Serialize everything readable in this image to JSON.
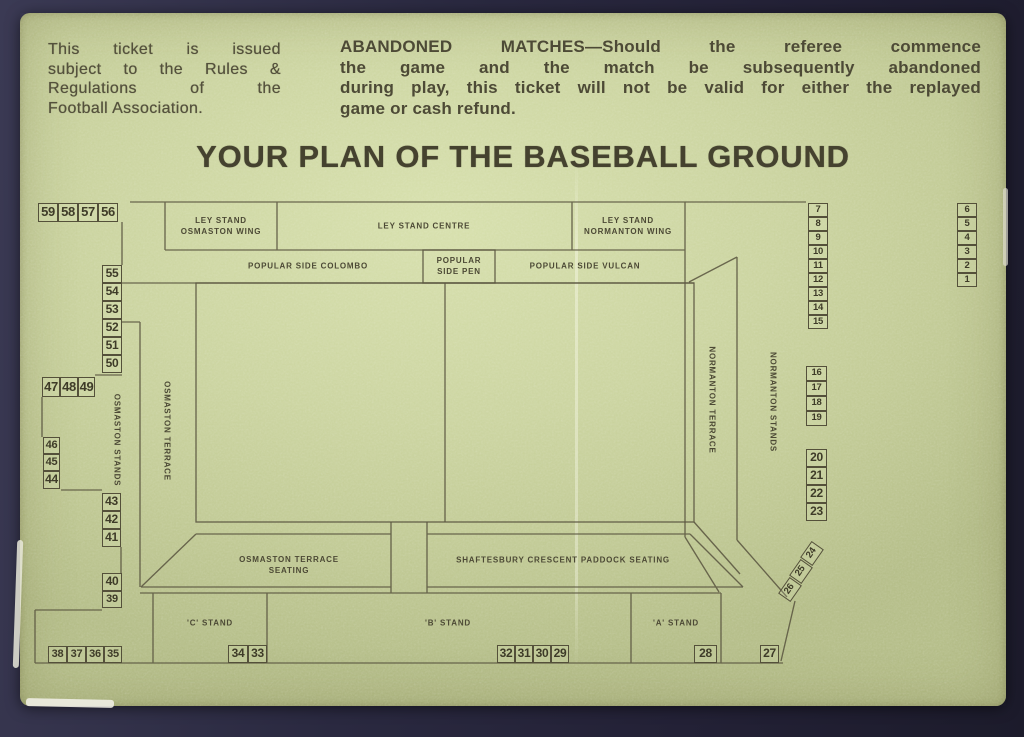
{
  "ticket": {
    "issue_notice": {
      "lines": [
        "This ticket is issued",
        "subject to the Rules &",
        "Regulations of the",
        "Football Association."
      ]
    },
    "abandoned_notice": {
      "lines": [
        "ABANDONED MATCHES—Should the referee commence",
        "the game and the match be subsequently abandoned",
        "during play, this ticket will not be valid for either the replayed",
        "game or cash refund."
      ]
    },
    "title": "YOUR PLAN OF THE BASEBALL GROUND"
  },
  "plan": {
    "labels": [
      {
        "id": "ley-stand-osmaston-wing",
        "text": "LEY STAND\nOSMASTON WING",
        "x": 221,
        "y": 227
      },
      {
        "id": "ley-stand-centre",
        "text": "LEY STAND CENTRE",
        "x": 424,
        "y": 227
      },
      {
        "id": "ley-stand-normanton-wing",
        "text": "LEY STAND\nNORMANTON WING",
        "x": 628,
        "y": 227
      },
      {
        "id": "popular-side-colombo",
        "text": "POPULAR SIDE  COLOMBO",
        "x": 308,
        "y": 267
      },
      {
        "id": "popular-side-pen",
        "text": "POPULAR\nSIDE PEN",
        "x": 459,
        "y": 267
      },
      {
        "id": "popular-side-vulcan",
        "text": "POPULAR SIDE  VULCAN",
        "x": 585,
        "y": 267
      },
      {
        "id": "osmaston-terrace-seating",
        "text": "OSMASTON TERRACE\nSEATING",
        "x": 289,
        "y": 566
      },
      {
        "id": "shaftesbury-crescent-paddock-seating",
        "text": "SHAFTESBURY CRESCENT PADDOCK SEATING",
        "x": 563,
        "y": 561
      },
      {
        "id": "c-stand",
        "text": "'C' STAND",
        "x": 210,
        "y": 624
      },
      {
        "id": "b-stand",
        "text": "'B' STAND",
        "x": 448,
        "y": 624
      },
      {
        "id": "a-stand",
        "text": "'A' STAND",
        "x": 676,
        "y": 624
      },
      {
        "id": "osmaston-stands",
        "text": "OSMASTON STANDS",
        "x": 116,
        "y": 440,
        "rot": 90
      },
      {
        "id": "osmaston-terrace",
        "text": "OSMASTON TERRACE",
        "x": 166,
        "y": 431,
        "rot": 90
      },
      {
        "id": "normanton-terrace",
        "text": "NORMANTON TERRACE",
        "x": 711,
        "y": 400,
        "rot": 90
      },
      {
        "id": "normanton-stands",
        "text": "NORMANTON STANDS",
        "x": 772,
        "y": 402,
        "rot": 90
      }
    ],
    "blocks": [
      {
        "n": 59,
        "x": 38,
        "y": 203,
        "w": 20,
        "h": 19
      },
      {
        "n": 58,
        "x": 58,
        "y": 203,
        "w": 20,
        "h": 19
      },
      {
        "n": 57,
        "x": 78,
        "y": 203,
        "w": 20,
        "h": 19
      },
      {
        "n": 56,
        "x": 98,
        "y": 203,
        "w": 20,
        "h": 19
      },
      {
        "n": 55,
        "x": 102,
        "y": 265,
        "w": 20,
        "h": 18
      },
      {
        "n": 54,
        "x": 102,
        "y": 283,
        "w": 20,
        "h": 18
      },
      {
        "n": 53,
        "x": 102,
        "y": 301,
        "w": 20,
        "h": 18
      },
      {
        "n": 52,
        "x": 102,
        "y": 319,
        "w": 20,
        "h": 18
      },
      {
        "n": 51,
        "x": 102,
        "y": 337,
        "w": 20,
        "h": 18
      },
      {
        "n": 50,
        "x": 102,
        "y": 355,
        "w": 20,
        "h": 18
      },
      {
        "n": 47,
        "x": 42,
        "y": 377,
        "w": 18,
        "h": 20
      },
      {
        "n": 48,
        "x": 60,
        "y": 377,
        "w": 18,
        "h": 20
      },
      {
        "n": 49,
        "x": 78,
        "y": 377,
        "w": 17,
        "h": 20
      },
      {
        "n": 46,
        "x": 43,
        "y": 437,
        "w": 17,
        "h": 17
      },
      {
        "n": 45,
        "x": 43,
        "y": 454,
        "w": 17,
        "h": 17
      },
      {
        "n": 44,
        "x": 43,
        "y": 471,
        "w": 17,
        "h": 18
      },
      {
        "n": 43,
        "x": 102,
        "y": 493,
        "w": 19,
        "h": 18
      },
      {
        "n": 42,
        "x": 102,
        "y": 511,
        "w": 19,
        "h": 18
      },
      {
        "n": 41,
        "x": 102,
        "y": 529,
        "w": 19,
        "h": 18
      },
      {
        "n": 40,
        "x": 102,
        "y": 573,
        "w": 20,
        "h": 18
      },
      {
        "n": 39,
        "x": 102,
        "y": 591,
        "w": 20,
        "h": 17
      },
      {
        "n": 38,
        "x": 48,
        "y": 646,
        "w": 19,
        "h": 17
      },
      {
        "n": 37,
        "x": 67,
        "y": 646,
        "w": 19,
        "h": 17
      },
      {
        "n": 36,
        "x": 86,
        "y": 646,
        "w": 18,
        "h": 17
      },
      {
        "n": 35,
        "x": 104,
        "y": 646,
        "w": 18,
        "h": 17
      },
      {
        "n": 34,
        "x": 228,
        "y": 645,
        "w": 20,
        "h": 18
      },
      {
        "n": 33,
        "x": 248,
        "y": 645,
        "w": 19,
        "h": 18
      },
      {
        "n": 32,
        "x": 497,
        "y": 645,
        "w": 18,
        "h": 18
      },
      {
        "n": 31,
        "x": 515,
        "y": 645,
        "w": 18,
        "h": 18
      },
      {
        "n": 30,
        "x": 533,
        "y": 645,
        "w": 18,
        "h": 18
      },
      {
        "n": 29,
        "x": 551,
        "y": 645,
        "w": 18,
        "h": 18
      },
      {
        "n": 28,
        "x": 694,
        "y": 645,
        "w": 23,
        "h": 18
      },
      {
        "n": 27,
        "x": 760,
        "y": 645,
        "w": 19,
        "h": 18
      },
      {
        "n": 26,
        "x": 780,
        "y": 582,
        "w": 20,
        "h": 15,
        "r": -55
      },
      {
        "n": 25,
        "x": 791,
        "y": 564,
        "w": 20,
        "h": 15,
        "r": -55
      },
      {
        "n": 24,
        "x": 802,
        "y": 546,
        "w": 20,
        "h": 15,
        "r": -55
      },
      {
        "n": 23,
        "x": 806,
        "y": 503,
        "w": 21,
        "h": 18
      },
      {
        "n": 22,
        "x": 806,
        "y": 485,
        "w": 21,
        "h": 18
      },
      {
        "n": 21,
        "x": 806,
        "y": 467,
        "w": 21,
        "h": 18
      },
      {
        "n": 20,
        "x": 806,
        "y": 449,
        "w": 21,
        "h": 18
      },
      {
        "n": 19,
        "x": 806,
        "y": 411,
        "w": 21,
        "h": 15
      },
      {
        "n": 18,
        "x": 806,
        "y": 396,
        "w": 21,
        "h": 15
      },
      {
        "n": 17,
        "x": 806,
        "y": 381,
        "w": 21,
        "h": 15
      },
      {
        "n": 16,
        "x": 806,
        "y": 366,
        "w": 21,
        "h": 15
      },
      {
        "n": 15,
        "x": 808,
        "y": 315,
        "w": 20,
        "h": 14
      },
      {
        "n": 14,
        "x": 808,
        "y": 301,
        "w": 20,
        "h": 14
      },
      {
        "n": 13,
        "x": 808,
        "y": 287,
        "w": 20,
        "h": 14
      },
      {
        "n": 12,
        "x": 808,
        "y": 273,
        "w": 20,
        "h": 14
      },
      {
        "n": 11,
        "x": 808,
        "y": 259,
        "w": 20,
        "h": 14
      },
      {
        "n": 10,
        "x": 808,
        "y": 245,
        "w": 20,
        "h": 14
      },
      {
        "n": 9,
        "x": 808,
        "y": 231,
        "w": 20,
        "h": 14
      },
      {
        "n": 8,
        "x": 808,
        "y": 217,
        "w": 20,
        "h": 14
      },
      {
        "n": 7,
        "x": 808,
        "y": 203,
        "w": 20,
        "h": 14
      },
      {
        "n": 6,
        "x": 957,
        "y": 203,
        "w": 20,
        "h": 14
      },
      {
        "n": 5,
        "x": 957,
        "y": 217,
        "w": 20,
        "h": 14
      },
      {
        "n": 4,
        "x": 957,
        "y": 231,
        "w": 20,
        "h": 14
      },
      {
        "n": 3,
        "x": 957,
        "y": 245,
        "w": 20,
        "h": 14
      },
      {
        "n": 2,
        "x": 957,
        "y": 259,
        "w": 20,
        "h": 14
      },
      {
        "n": 1,
        "x": 957,
        "y": 273,
        "w": 20,
        "h": 14
      }
    ]
  },
  "colors": {
    "paper": "#cbd49f",
    "ink": "#4d4a36",
    "outline": "#5b5741",
    "backdrop": "#2a2940"
  }
}
